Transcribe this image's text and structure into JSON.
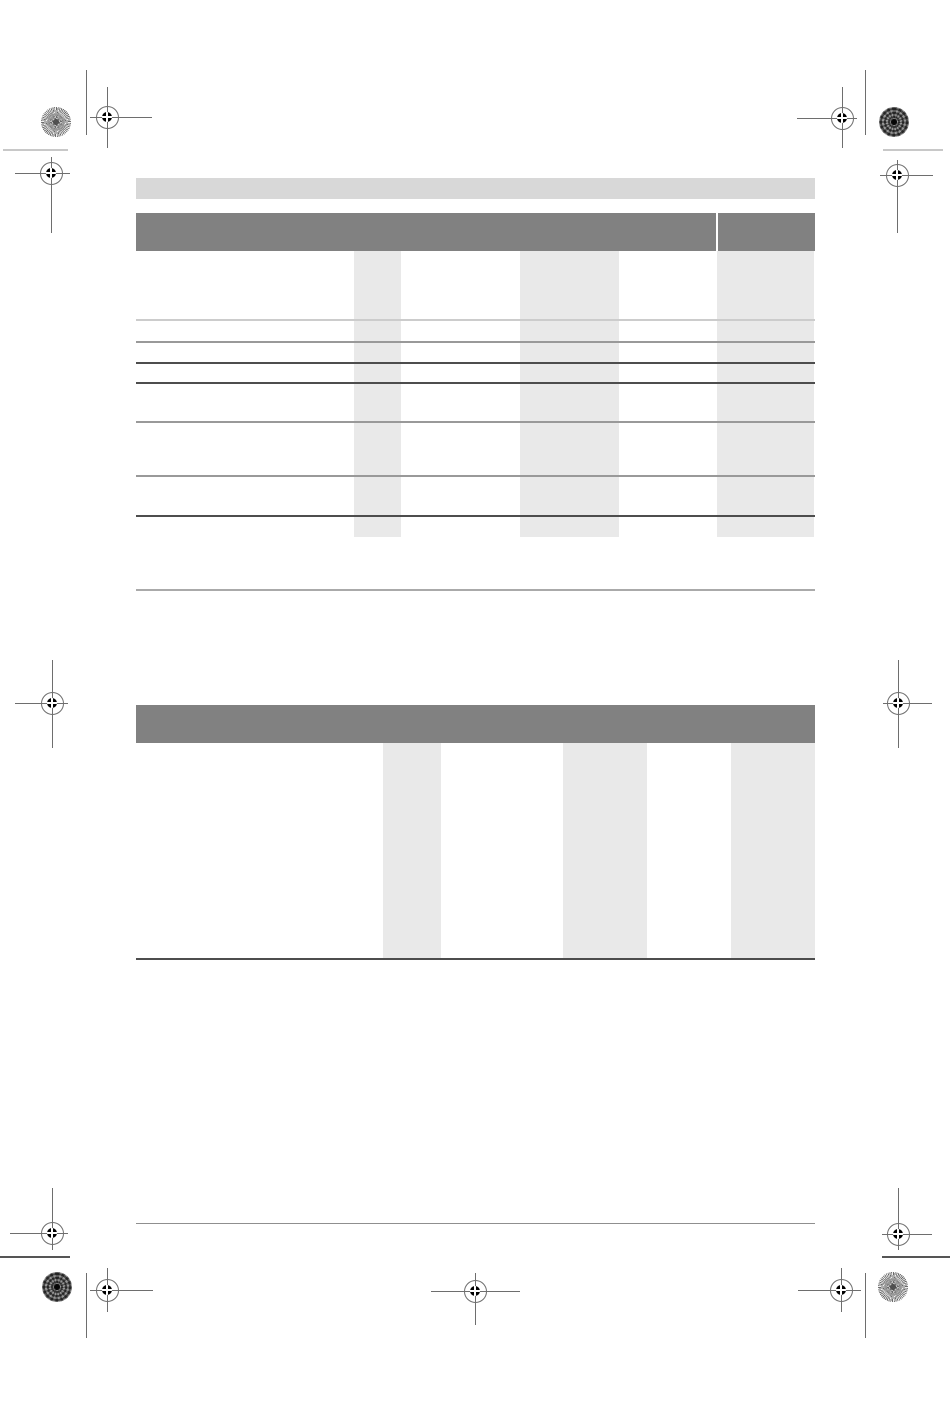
{
  "page": {
    "width_px": 950,
    "height_px": 1409,
    "background": "#ffffff",
    "visible_text": ""
  },
  "colors": {
    "top_bar": "#d8d8d8",
    "table_header": "#818181",
    "column_band": "#e9e9e9",
    "row_line_light": "#cccccc",
    "row_line_medium": "#999999",
    "row_line_dark": "#4d4d4d",
    "separator_line": "#aaaaaa",
    "footer_line": "#8f8f8f",
    "mark_line": "#6e6e6e",
    "mark_light_line": "#c8c8c8",
    "mark_dark_line": "#555555",
    "mark_dot": "#000000"
  },
  "tables": [
    {
      "name": "upper-table",
      "header_label": "",
      "header_has_right_divider": true,
      "shaded_column_count": 3,
      "row_separator_count": 7
    },
    {
      "name": "lower-table",
      "header_label": "",
      "header_has_right_divider": false,
      "shaded_column_count": 3,
      "row_separator_count": 0
    }
  ],
  "print_marks": {
    "registration_target_count": 11,
    "color_patch_count": 4,
    "crop_line_count": 8
  }
}
